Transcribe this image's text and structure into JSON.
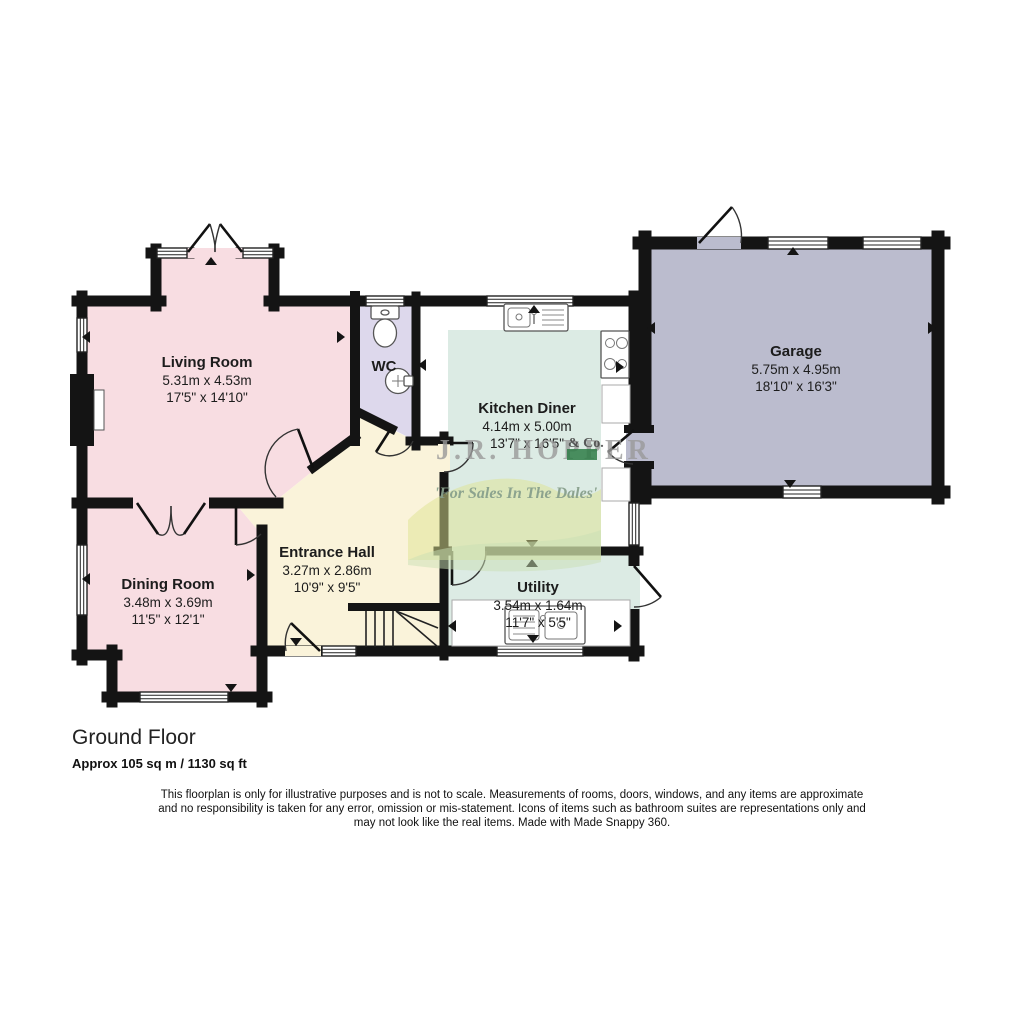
{
  "floorplan": {
    "floor_title": "Ground Floor",
    "floor_area": "Approx 105 sq m / 1130 sq ft",
    "disclaimer": {
      "line1": "This floorplan is only for illustrative purposes and is not to scale. Measurements of rooms, doors, windows, and any items are approximate",
      "line2": "and no responsibility is taken for any error, omission or mis-statement. Icons of items such as bathroom suites are representations only and",
      "line3": "may not look like the real items. Made with Made Snappy 360."
    },
    "watermark": {
      "name": "J.R. HOPPER",
      "suffix": "& Co.",
      "tagline": "'For Sales In The Dales'"
    },
    "rooms": [
      {
        "name": "Living Room",
        "metric": "5.31m x 4.53m",
        "imperial": "17'5\" x 14'10\""
      },
      {
        "name": "Dining Room",
        "metric": "3.48m x 3.69m",
        "imperial": "11'5\" x 12'1\""
      },
      {
        "name": "Entrance Hall",
        "metric": "3.27m x 2.86m",
        "imperial": "10'9\" x 9'5\""
      },
      {
        "name": "WC"
      },
      {
        "name": "Kitchen Diner",
        "metric": "4.14m x 5.00m",
        "imperial": "13'7\" x 16'5\""
      },
      {
        "name": "Utility",
        "metric": "3.54m x 1.64m",
        "imperial": "11'7\" x 5'5\""
      },
      {
        "name": "Garage",
        "metric": "5.75m x 4.95m",
        "imperial": "18'10\" x 16'3\""
      }
    ],
    "colors": {
      "room_pink": "#f8dde2",
      "room_cream": "#faf3da",
      "room_lavender": "#ddd8ec",
      "room_teal": "#dcebe4",
      "room_garage": "#bbbcce",
      "wall": "#141414",
      "watermark_green": "#2e7d46",
      "hill_yellow": "#dde48f",
      "hill_green": "#cadfb4"
    }
  }
}
